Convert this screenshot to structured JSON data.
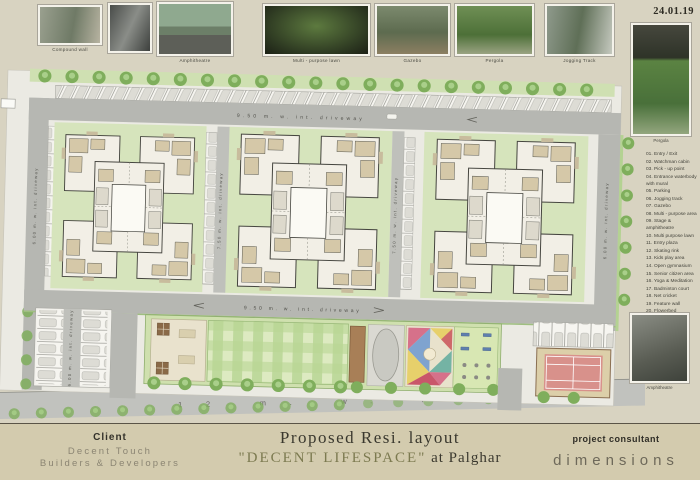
{
  "date": "24.01.19",
  "gallery": {
    "captions": [
      "Compound wall",
      "",
      "Amphitheatre",
      "Multi - purpose lawn",
      "Gazebo",
      "Pergola",
      "Jogging Track"
    ]
  },
  "side": {
    "pergola_caption": "Pergola",
    "amphitheatre_caption": "Amphitheatre",
    "legend": [
      "01. Entry / Exit",
      "02. Watchman cabin",
      "03. Pick - up point",
      "04. Entrance waterbody with mural",
      "05. Parking",
      "06. Jogging track",
      "07. Gazebo",
      "08. Multi - purpose area",
      "09. Stage & amphitheatre",
      "10. Multi purpose lawn",
      "11. Entry plaza",
      "12. Skating rink",
      "13. Kids play area",
      "14. Open gymnasium",
      "15. Senior citizen area",
      "16. Yoga & Meditation",
      "17. Badminton court",
      "18. Net cricket",
      "19. Feature wall",
      "20. Flowerbed"
    ]
  },
  "roads": {
    "top_driveway": "9.50 m. w. int. driveway",
    "mid_driveway": "9.50 m. w. int. driveway",
    "left_driveway": "6.00 m. w. int. driveway",
    "inner_driveway": "7.50 m. w. int. driveway",
    "right_driveway": "6.00 m. w. int. driveway",
    "parking_driveway": "6.00 m. w. int. driveway",
    "main_road": "12 m. w. road",
    "entry_exit": "Entry / Exit"
  },
  "titleblock": {
    "client_label": "Client",
    "client_line1": "Decent Touch",
    "client_line2": "Builders & Developers",
    "title_line1": "Proposed Resi. layout",
    "title_quote": "\"DECENT LIFESPACE\"",
    "title_suffix": " at Palghar",
    "consultant_label": "project consultant",
    "consultant_name": "dimensions"
  }
}
